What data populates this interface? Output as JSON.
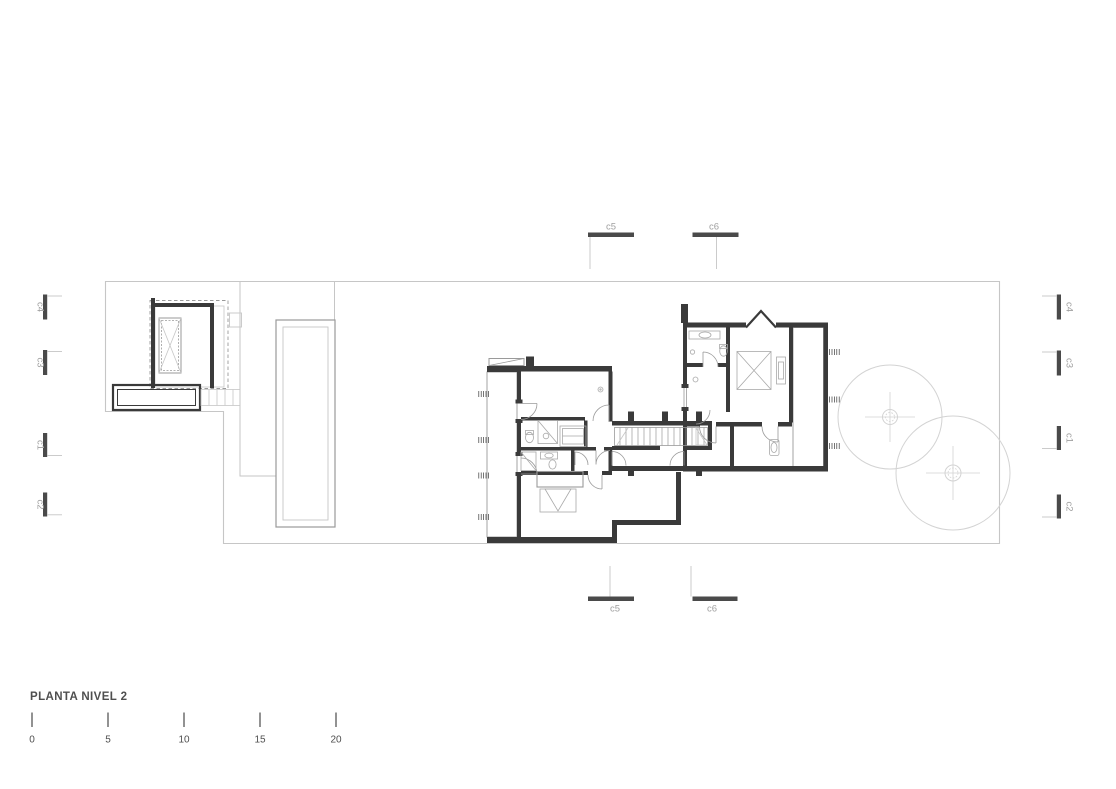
{
  "title": "PLANTA NIVEL 2",
  "scale_bar": {
    "labels": [
      "0",
      "5",
      "10",
      "15",
      "20"
    ]
  },
  "markers": {
    "top": [
      "c5",
      "c6"
    ],
    "bottom": [
      "c5",
      "c6"
    ],
    "left": [
      "c4",
      "c3",
      "c1",
      "c2"
    ],
    "right": [
      "c4",
      "c3",
      "c1",
      "c2"
    ]
  },
  "colors": {
    "background": "#ffffff",
    "wall": "#3a3a3a",
    "line_medium": "#9a9a9a",
    "line_light": "#c6c6c6",
    "marker_bar": "#4a4a4a",
    "label": "#a0a0a0",
    "text": "#4f4f4f"
  }
}
